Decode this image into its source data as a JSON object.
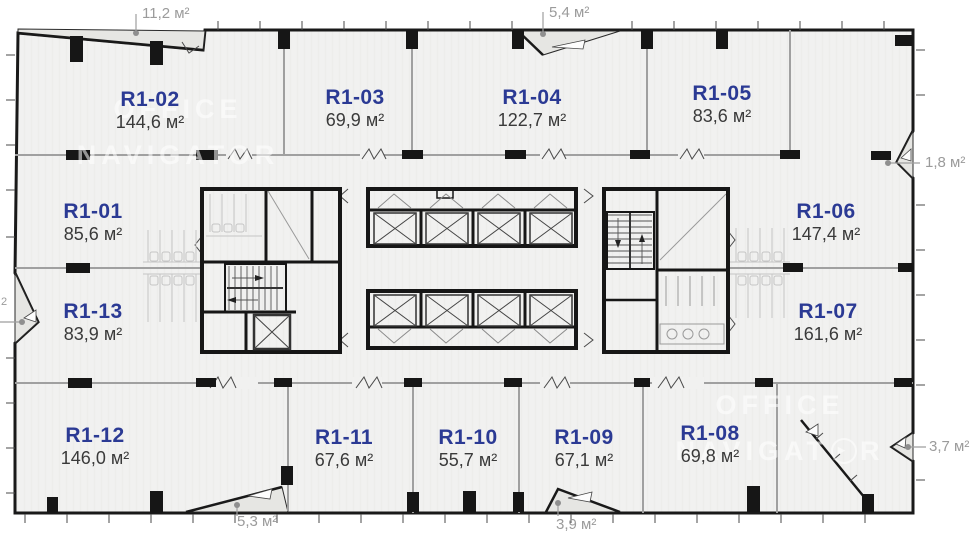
{
  "watermark": {
    "line1": "OFFICE",
    "line2": "NAVIGATOR",
    "line2_pre": "NAVIGAT",
    "line2_post": "R"
  },
  "rooms": [
    {
      "code": "R1-02",
      "area": "144,6 м²"
    },
    {
      "code": "R1-03",
      "area": "69,9 м²"
    },
    {
      "code": "R1-04",
      "area": "122,7 м²"
    },
    {
      "code": "R1-05",
      "area": "83,6 м²"
    },
    {
      "code": "R1-01",
      "area": "85,6 м²"
    },
    {
      "code": "R1-13",
      "area": "83,9 м²"
    },
    {
      "code": "R1-06",
      "area": "147,4 м²"
    },
    {
      "code": "R1-07",
      "area": "161,6 м²"
    },
    {
      "code": "R1-12",
      "area": "146,0 м²"
    },
    {
      "code": "R1-11",
      "area": "67,6 м²"
    },
    {
      "code": "R1-10",
      "area": "55,7 м²"
    },
    {
      "code": "R1-09",
      "area": "67,1 м²"
    },
    {
      "code": "R1-08",
      "area": "69,8 м²"
    }
  ],
  "dimensions": [
    {
      "text": "11,2 м²"
    },
    {
      "text": "5,4 м²"
    },
    {
      "text": "1,8 м²"
    },
    {
      "text": "3,7 м²"
    },
    {
      "text": "5,3 м²"
    },
    {
      "text": "3,9 м²"
    },
    {
      "text": "2"
    }
  ],
  "colors": {
    "room_code": "#2b3a94",
    "room_area": "#3a3a3a",
    "dimension": "#9b9b9b",
    "floor": "#f1f1f0",
    "balcony": "#e6e6e3",
    "wall_dark": "#191919",
    "wall_light": "#a0a0a0",
    "watermark": "rgba(255,255,255,0.55)"
  }
}
